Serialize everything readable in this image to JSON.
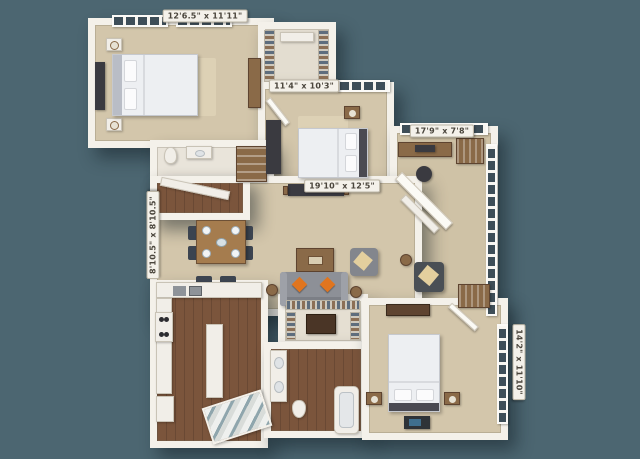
{
  "scene": {
    "description": "3D isometric apartment floor plan rendering on slate background"
  },
  "colors": {
    "background": "#4c6671",
    "wall": "#f4f1ea",
    "carpet": "#d3c6ab",
    "carpet-light": "#ddd1b5",
    "wood": "#7b553c",
    "furn-wood": "#8a6a48",
    "white-furn": "#f1eee8",
    "dark-furn": "#3a3a40",
    "sofa": "#8d9097",
    "accent-orange": "#e0751f",
    "window-pane": "#3e4e58",
    "label-text": "#4a453c"
  },
  "labels": {
    "bedroom1": {
      "text": "12'6.5\" x 11'11\""
    },
    "bedroom2": {
      "text": "11'4\" x 10'3\""
    },
    "sunroom": {
      "text": "17'9\" x 7'8\""
    },
    "living": {
      "text": "19'10\" x 12'5\""
    },
    "dining": {
      "text": "8'10.5\" x 8'10.5\""
    },
    "bedroom3": {
      "text": "14'2\" x 11'10\""
    }
  }
}
